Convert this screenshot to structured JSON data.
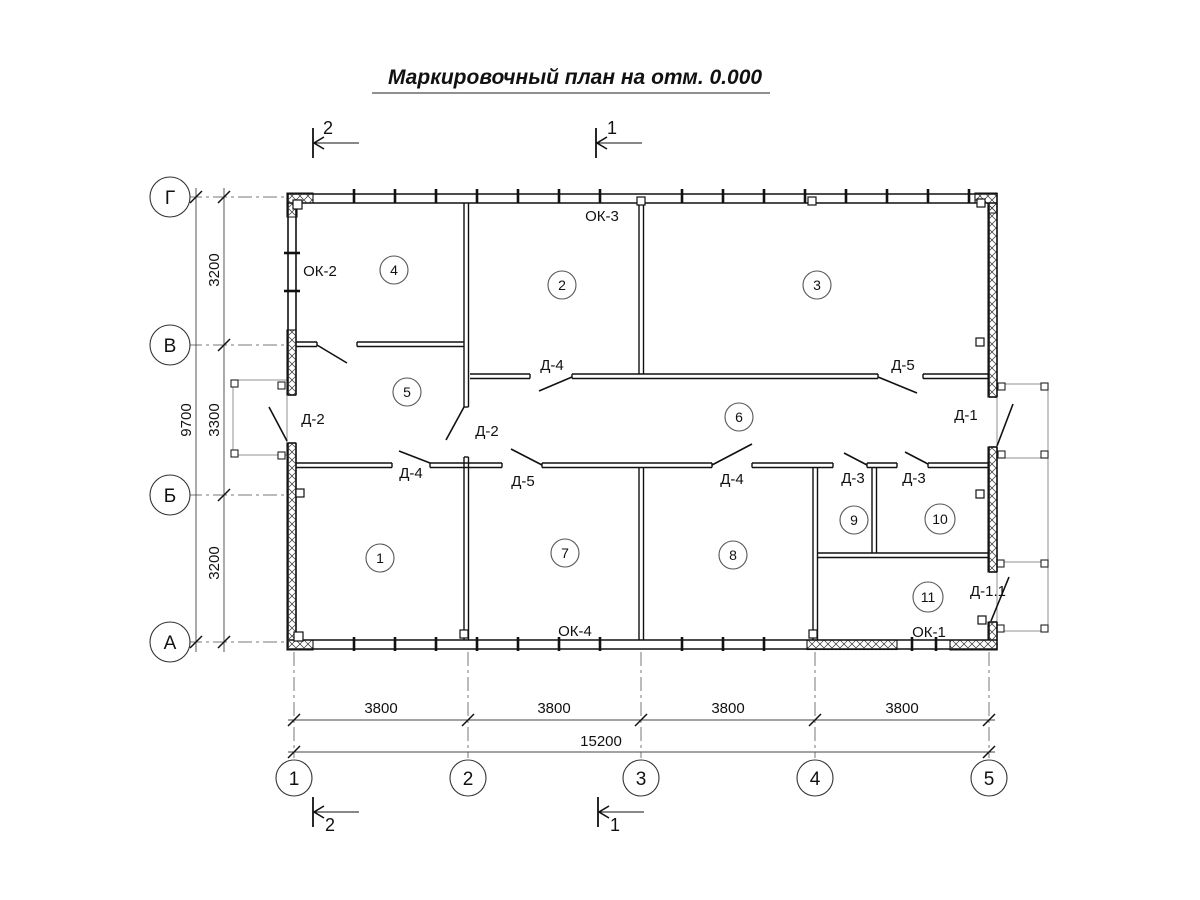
{
  "title": "Маркировочный план на отм. 0.000",
  "grid": {
    "rows": [
      {
        "label": "Г"
      },
      {
        "label": "В"
      },
      {
        "label": "Б"
      },
      {
        "label": "А"
      }
    ],
    "cols": [
      {
        "label": "1"
      },
      {
        "label": "2"
      },
      {
        "label": "3"
      },
      {
        "label": "4"
      },
      {
        "label": "5"
      }
    ]
  },
  "dimensions": {
    "left": {
      "total": "9700",
      "segments": [
        "3200",
        "3300",
        "3200"
      ]
    },
    "bottom": {
      "segments": [
        "3800",
        "3800",
        "3800",
        "3800"
      ],
      "total": "15200"
    }
  },
  "rooms": [
    "1",
    "2",
    "3",
    "4",
    "5",
    "6",
    "7",
    "8",
    "9",
    "10",
    "11"
  ],
  "labels": {
    "d1": "Д-1",
    "d11": "Д-1.1",
    "d2": "Д-2",
    "d3": "Д-3",
    "d4": "Д-4",
    "d5": "Д-5",
    "ok1": "ОК-1",
    "ok2": "ОК-2",
    "ok3": "ОК-3",
    "ok4": "ОК-4"
  },
  "sections": {
    "s1": "1",
    "s2": "2"
  }
}
